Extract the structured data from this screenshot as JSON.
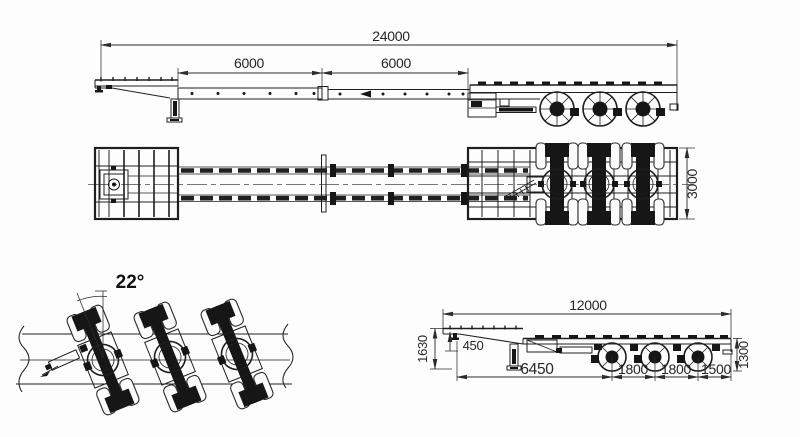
{
  "drawing": {
    "title": "three-axle extendable trailer engineering drawing",
    "colors": {
      "line": "#1e1e1e",
      "dimension_text": "#262626",
      "background": "#fdfdfd"
    },
    "views": {
      "extended_side": {
        "overall_length": "24000",
        "front_extension": "6000",
        "rear_extension": "6000"
      },
      "plan": {
        "deck_width": "3000"
      },
      "steering_detail": {
        "steering_angle": "22°"
      },
      "retracted_side": {
        "overall_length": "12000",
        "gooseneck_height": "1630",
        "gooseneck_drop": "450",
        "kingpin_to_first_axle": "6450",
        "axle_spacing_1": "1800",
        "axle_spacing_2": "1800",
        "rear_section": "1500",
        "deck_height": "1300"
      }
    }
  }
}
